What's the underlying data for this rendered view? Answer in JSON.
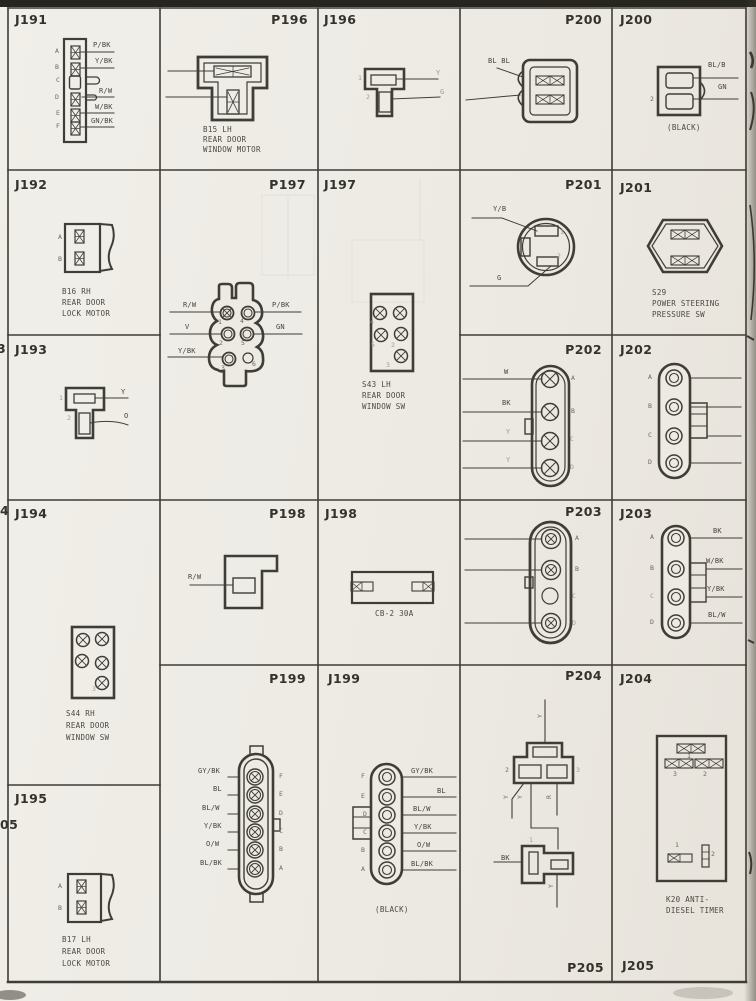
{
  "page": {
    "left_margin_partials": [
      "3",
      "4",
      "05"
    ]
  },
  "cells": {
    "J191": {
      "title": "J191",
      "pin_labels": [
        "A",
        "B",
        "C",
        "D",
        "E",
        "F"
      ],
      "wire_labels": [
        "P/BK",
        "Y/BK",
        "R/W",
        "W/BK",
        "GN/BK"
      ]
    },
    "P196": {
      "title": "P196",
      "caption_lines": [
        "B15 LH",
        "REAR DOOR",
        "WINDOW MOTOR"
      ]
    },
    "J196": {
      "title": "J196",
      "pin_labels": [
        "1",
        "2"
      ],
      "wire_labels": [
        "Y",
        "G"
      ]
    },
    "P200": {
      "title": "P200",
      "wire_labels": [
        "BL BL"
      ]
    },
    "J200": {
      "title": "J200",
      "pin_labels": [
        "2"
      ],
      "wire_labels": [
        "BL/B",
        "GN"
      ],
      "caption_lines": [
        "(BLACK)"
      ]
    },
    "J192": {
      "title": "J192",
      "pin_labels": [
        "A",
        "B"
      ],
      "caption_lines": [
        "B16 RH",
        "REAR DOOR",
        "LOCK MOTOR"
      ]
    },
    "P197": {
      "title": "P197",
      "pin_labels": [
        "1",
        "2",
        "3",
        "4",
        "5",
        "6"
      ],
      "wire_labels_left": [
        "R/W",
        "V",
        "Y/BK"
      ],
      "wire_labels_right": [
        "P/BK",
        "GN"
      ]
    },
    "J197": {
      "title": "J197",
      "pin_labels": [
        "4",
        "5",
        "2",
        "3"
      ],
      "caption_lines": [
        "S43 LH",
        "REAR DOOR",
        "WINDOW SW"
      ]
    },
    "P201": {
      "title": "P201",
      "pin_labels": [
        "1",
        "2"
      ],
      "wire_labels": [
        "Y/B",
        "G"
      ]
    },
    "J201": {
      "title": "J201",
      "caption_lines": [
        "S29",
        "POWER STEERING",
        "PRESSURE SW"
      ]
    },
    "P202": {
      "title": "P202",
      "pin_labels": [
        "A",
        "B",
        "C",
        "D"
      ],
      "wire_labels": [
        "W",
        "BK",
        "Y",
        "Y"
      ]
    },
    "J202": {
      "title": "J202",
      "pin_labels": [
        "A",
        "B",
        "C",
        "D"
      ]
    },
    "J193": {
      "title": "J193",
      "pin_labels": [
        "1",
        "2"
      ],
      "wire_labels": [
        "Y",
        "O"
      ]
    },
    "J194": {
      "title": "J194",
      "pin_labels": [
        "3"
      ],
      "caption_lines": [
        "S44 RH",
        "REAR DOOR",
        "WINDOW SW"
      ]
    },
    "P198": {
      "title": "P198",
      "wire_labels": [
        "R/W"
      ]
    },
    "J198": {
      "title": "J198",
      "caption_lines": [
        "CB-2 30A"
      ]
    },
    "P203": {
      "title": "P203",
      "pin_labels": [
        "A",
        "B",
        "C",
        "D"
      ]
    },
    "J203": {
      "title": "J203",
      "pin_labels": [
        "A",
        "B",
        "C",
        "D"
      ],
      "wire_labels": [
        "BK",
        "W/BK",
        "Y/BK",
        "BL/W"
      ]
    },
    "J195": {
      "title": "J195",
      "pin_labels": [
        "A",
        "B"
      ],
      "caption_lines": [
        "B17 LH",
        "REAR DOOR",
        "LOCK MOTOR"
      ]
    },
    "P199": {
      "title": "P199",
      "pin_labels": [
        "F",
        "E",
        "D",
        "C",
        "B",
        "A"
      ],
      "wire_labels": [
        "GY/BK",
        "BL",
        "BL/W",
        "Y/BK",
        "O/W",
        "BL/BK"
      ]
    },
    "J199": {
      "title": "J199",
      "pin_labels": [
        "F",
        "E",
        "D",
        "C",
        "B",
        "A"
      ],
      "wire_labels": [
        "GY/BK",
        "BL",
        "BL/W",
        "Y/BK",
        "O/W",
        "BL/BK"
      ],
      "caption_lines": [
        "(BLACK)"
      ]
    },
    "P204": {
      "title": "P204",
      "pin_labels": [
        "2",
        "3"
      ],
      "rotated_wire_labels": [
        "Y",
        "Y",
        "Y",
        "R"
      ],
      "pigtail": {
        "pin": "1",
        "wire": "BK",
        "rotated": "Y"
      }
    },
    "P205": {
      "title": "P205"
    },
    "J204": {
      "title": "J204",
      "upper_pin_labels": [
        "1",
        "3",
        "2"
      ],
      "lower_pin_labels": [
        "1",
        "2"
      ],
      "caption_lines": [
        "K20 ANTI-",
        "DIESEL TIMER"
      ]
    },
    "J205": {
      "title": "J205"
    }
  }
}
